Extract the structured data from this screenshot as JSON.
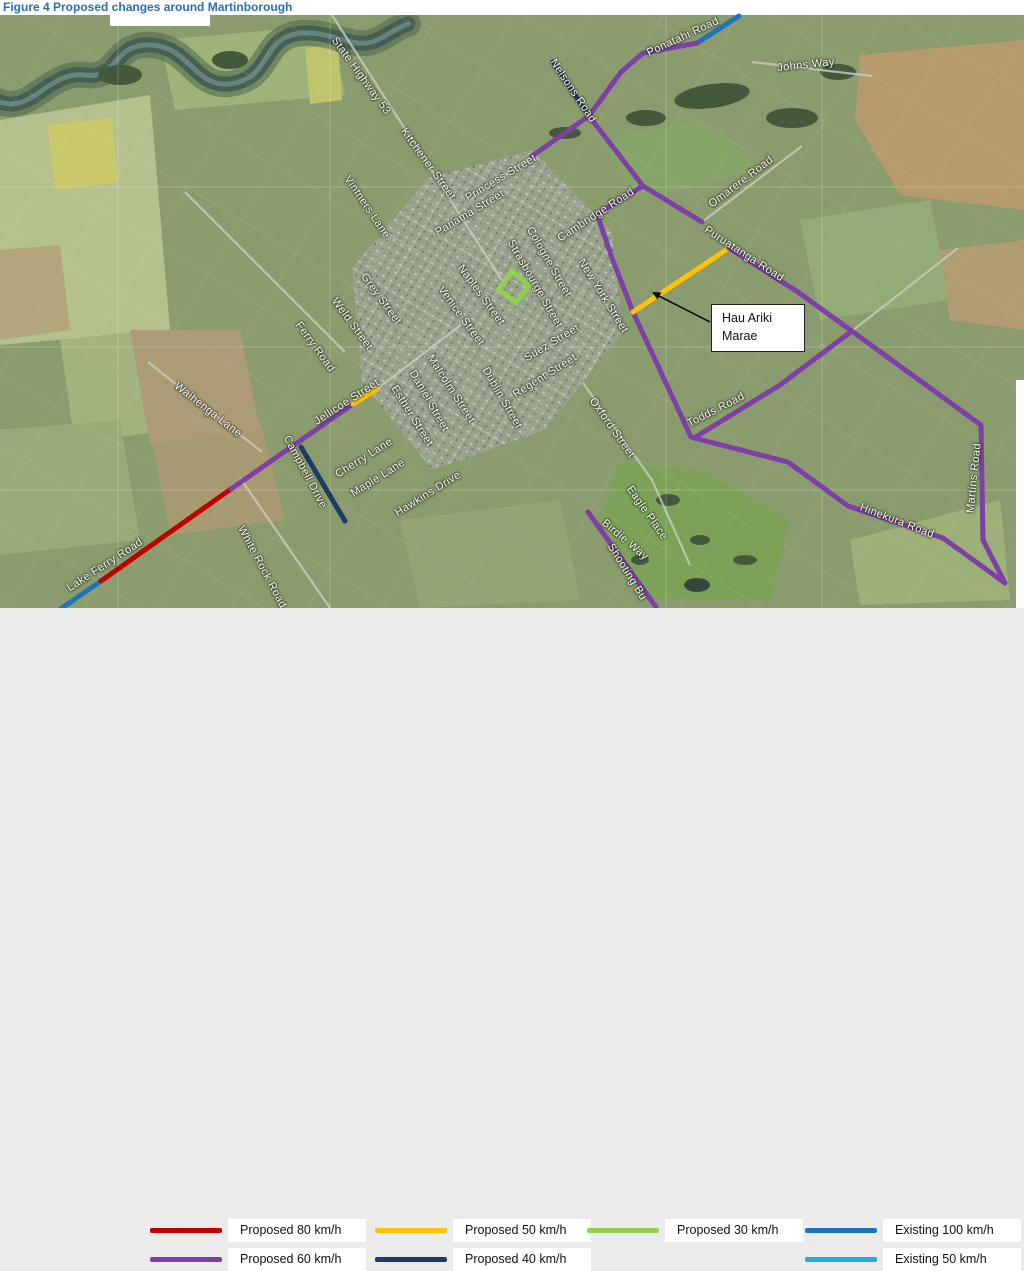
{
  "figure_title": "Figure 4 Proposed changes around Martinborough",
  "callout": {
    "text": "Hau Ariki Marae"
  },
  "legend": {
    "items": [
      {
        "label": "Proposed 80 km/h",
        "color": "#c00000"
      },
      {
        "label": "Proposed 50 km/h",
        "color": "#ffc008"
      },
      {
        "label": "Proposed 30 km/h",
        "color": "#92d050"
      },
      {
        "label": "Existing 100 km/h",
        "color": "#1c75bc"
      },
      {
        "label": "Proposed 60 km/h",
        "color": "#7e3fa6"
      },
      {
        "label": "Proposed 40 km/h",
        "color": "#1e3a66"
      },
      {
        "label": "Existing 50 km/h",
        "color": "#27aae1"
      }
    ]
  },
  "map": {
    "marker_30_color": "#92d050",
    "routes": [
      {
        "name": "lake-ferry-existing-100",
        "color": "#1c75bc",
        "pts": [
          [
            56,
            612
          ],
          [
            101,
            581
          ]
        ]
      },
      {
        "name": "lake-ferry-proposed-80",
        "color": "#c00000",
        "pts": [
          [
            101,
            581
          ],
          [
            231,
            489
          ]
        ]
      },
      {
        "name": "jellicoe-proposed-60",
        "color": "#7e3fa6",
        "pts": [
          [
            231,
            489
          ],
          [
            353,
            404
          ]
        ]
      },
      {
        "name": "jellicoe-proposed-50",
        "color": "#ffc008",
        "pts": [
          [
            353,
            404
          ],
          [
            377,
            389
          ]
        ]
      },
      {
        "name": "campbell-drive-proposed-40",
        "color": "#1e3a66",
        "pts": [
          [
            301,
            447
          ],
          [
            345,
            521
          ]
        ]
      },
      {
        "name": "nelsons-road-proposed-40",
        "color": "#1e3a66",
        "pts": [
          [
            553,
            62
          ],
          [
            589,
            116
          ]
        ]
      },
      {
        "name": "ponatahi-existing-100",
        "color": "#1c75bc",
        "pts": [
          [
            697,
            43
          ],
          [
            739,
            16
          ]
        ]
      },
      {
        "name": "ponatahi-proposed-60",
        "color": "#7e3fa6",
        "pts": [
          [
            697,
            43
          ],
          [
            643,
            53
          ],
          [
            621,
            72
          ],
          [
            589,
            116
          ]
        ]
      },
      {
        "name": "princess-street-proposed-60",
        "color": "#7e3fa6",
        "pts": [
          [
            589,
            116
          ],
          [
            532,
            156
          ]
        ]
      },
      {
        "name": "cambridge-new-york-proposed-60",
        "color": "#7e3fa6",
        "pts": [
          [
            589,
            116
          ],
          [
            643,
            186
          ],
          [
            597,
            214
          ],
          [
            612,
            258
          ],
          [
            633,
            312
          ],
          [
            691,
            437
          ]
        ]
      },
      {
        "name": "omarere-spur-proposed-60",
        "color": "#7e3fa6",
        "pts": [
          [
            643,
            186
          ],
          [
            702,
            222
          ]
        ]
      },
      {
        "name": "puruatanga-proposed-50",
        "color": "#ffc008",
        "pts": [
          [
            633,
            312
          ],
          [
            729,
            248
          ]
        ]
      },
      {
        "name": "puruatanga-proposed-60",
        "color": "#7e3fa6",
        "pts": [
          [
            729,
            248
          ],
          [
            798,
            292
          ],
          [
            981,
            425
          ]
        ]
      },
      {
        "name": "martins-road-proposed-60",
        "color": "#7e3fa6",
        "pts": [
          [
            981,
            425
          ],
          [
            983,
            540
          ],
          [
            1005,
            583
          ]
        ]
      },
      {
        "name": "todds-road-proposed-60",
        "color": "#7e3fa6",
        "pts": [
          [
            852,
            331
          ],
          [
            780,
            385
          ],
          [
            694,
            438
          ]
        ]
      },
      {
        "name": "hinekura-proposed-60",
        "color": "#7e3fa6",
        "pts": [
          [
            694,
            438
          ],
          [
            788,
            462
          ],
          [
            848,
            506
          ],
          [
            943,
            538
          ],
          [
            1005,
            583
          ]
        ]
      },
      {
        "name": "shooting-butts-proposed-60",
        "color": "#7e3fa6",
        "pts": [
          [
            588,
            512
          ],
          [
            656,
            607
          ]
        ]
      }
    ],
    "labels": [
      {
        "t": "State Highway 53",
        "x": 361,
        "y": 76,
        "r": 54
      },
      {
        "t": "Kitchener Street",
        "x": 428,
        "y": 164,
        "r": 54
      },
      {
        "t": "Vintners Lane",
        "x": 367,
        "y": 207,
        "r": 56
      },
      {
        "t": "Princess Street",
        "x": 501,
        "y": 178,
        "r": -31
      },
      {
        "t": "Panama Street",
        "x": 470,
        "y": 213,
        "r": -31
      },
      {
        "t": "Naples Street",
        "x": 481,
        "y": 295,
        "r": 54
      },
      {
        "t": "Venice Street",
        "x": 461,
        "y": 316,
        "r": 54
      },
      {
        "t": "Cologne Street",
        "x": 549,
        "y": 262,
        "r": 60
      },
      {
        "t": "Strasbourge Street",
        "x": 535,
        "y": 284,
        "r": 60
      },
      {
        "t": "New York Street",
        "x": 603,
        "y": 296,
        "r": 58
      },
      {
        "t": "Cambridge Road",
        "x": 596,
        "y": 215,
        "r": -33
      },
      {
        "t": "Omarere Road",
        "x": 741,
        "y": 182,
        "r": -37
      },
      {
        "t": "Puruatanga Road",
        "x": 744,
        "y": 254,
        "r": 33
      },
      {
        "t": "Ponatahi Road",
        "x": 683,
        "y": 37,
        "r": -25
      },
      {
        "t": "Nelsons Road",
        "x": 573,
        "y": 91,
        "r": 56
      },
      {
        "t": "Johns Way",
        "x": 806,
        "y": 65,
        "r": -6
      },
      {
        "t": "Grey Street",
        "x": 381,
        "y": 299,
        "r": 54
      },
      {
        "t": "Weld Street",
        "x": 352,
        "y": 324,
        "r": 54
      },
      {
        "t": "Ferry Road",
        "x": 315,
        "y": 347,
        "r": 54
      },
      {
        "t": "Malcolm Street",
        "x": 451,
        "y": 389,
        "r": 57
      },
      {
        "t": "Daniel Street",
        "x": 429,
        "y": 401,
        "r": 60
      },
      {
        "t": "Esther Street",
        "x": 412,
        "y": 416,
        "r": 58
      },
      {
        "t": "Dublin Street",
        "x": 502,
        "y": 398,
        "r": 60
      },
      {
        "t": "Suez Street",
        "x": 552,
        "y": 343,
        "r": -31
      },
      {
        "t": "Regent Street",
        "x": 545,
        "y": 376,
        "r": -32
      },
      {
        "t": "Oxford Street",
        "x": 612,
        "y": 428,
        "r": 55
      },
      {
        "t": "Jellicoe Street",
        "x": 347,
        "y": 402,
        "r": -33
      },
      {
        "t": "Cherry Lane",
        "x": 364,
        "y": 458,
        "r": -32
      },
      {
        "t": "Maple Lane",
        "x": 378,
        "y": 478,
        "r": -32
      },
      {
        "t": "Hawkins Drive",
        "x": 428,
        "y": 494,
        "r": -32
      },
      {
        "t": "Campbell Drive",
        "x": 305,
        "y": 472,
        "r": 62
      },
      {
        "t": "White Rock Road",
        "x": 262,
        "y": 567,
        "r": 62
      },
      {
        "t": "Lake Ferry Road",
        "x": 105,
        "y": 565,
        "r": -33
      },
      {
        "t": "Waihenga Lane",
        "x": 208,
        "y": 410,
        "r": 38
      },
      {
        "t": "Todds Road",
        "x": 716,
        "y": 410,
        "r": -27
      },
      {
        "t": "Eagle Place",
        "x": 647,
        "y": 513,
        "r": 55
      },
      {
        "t": "Birdie Way",
        "x": 625,
        "y": 540,
        "r": 40
      },
      {
        "t": "Shooting Bu",
        "x": 627,
        "y": 572,
        "r": 58
      },
      {
        "t": "Martins Road",
        "x": 974,
        "y": 478,
        "r": -84
      },
      {
        "t": "Hinekura Road",
        "x": 897,
        "y": 521,
        "r": 21
      }
    ]
  }
}
